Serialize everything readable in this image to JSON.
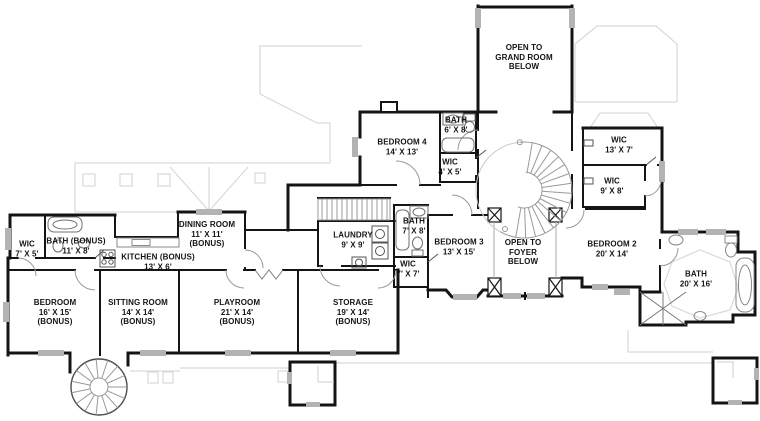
{
  "plan": {
    "colors": {
      "wall": "#141414",
      "roof_outline": "#d9d9d9",
      "window_gray": "#b3b3b3",
      "fixture": "#707070",
      "background": "#ffffff"
    },
    "rooms": [
      {
        "id": "grand-room-open",
        "text": "OPEN TO\nGRAND ROOM\nBELOW"
      },
      {
        "id": "bedroom-4",
        "text": "BEDROOM 4\n14' X 13'"
      },
      {
        "id": "bath-bedroom-4",
        "text": "BATH\n6' X 8'"
      },
      {
        "id": "wic-bedroom-4",
        "text": "WIC\n4' X 5'"
      },
      {
        "id": "wic-13x7",
        "text": "WIC\n13' X 7'"
      },
      {
        "id": "wic-9x8",
        "text": "WIC\n9' X 8'"
      },
      {
        "id": "bedroom-2",
        "text": "BEDROOM 2\n20' X 14'"
      },
      {
        "id": "bath-master",
        "text": "BATH\n20' X 16'"
      },
      {
        "id": "bedroom-3",
        "text": "BEDROOM 3\n13' X 15'"
      },
      {
        "id": "foyer-open",
        "text": "OPEN TO\nFOYER\nBELOW"
      },
      {
        "id": "bath-bedroom-3",
        "text": "BATH\n7' X 8'"
      },
      {
        "id": "wic-7x7",
        "text": "WIC\n7' X 7'"
      },
      {
        "id": "laundry",
        "text": "LAUNDRY\n9' X 9'"
      },
      {
        "id": "dining-room",
        "text": "DINING ROOM\n11' X 11'\n(BONUS)"
      },
      {
        "id": "kitchen",
        "text": "KITCHEN (BONUS)\n13' X 6'"
      },
      {
        "id": "bath-bonus",
        "text": "BATH (BONUS)\n11' X 8'"
      },
      {
        "id": "wic-7x5",
        "text": "WIC\n7' X 5'"
      },
      {
        "id": "bedroom-bonus",
        "text": "BEDROOM\n16' X 15'\n(BONUS)"
      },
      {
        "id": "sitting-room",
        "text": "SITTING ROOM\n14' X 14'\n(BONUS)"
      },
      {
        "id": "playroom",
        "text": "PLAYROOM\n21' X 14'\n(BONUS)"
      },
      {
        "id": "storage",
        "text": "STORAGE\n19' X 14'\n(BONUS)"
      }
    ]
  }
}
